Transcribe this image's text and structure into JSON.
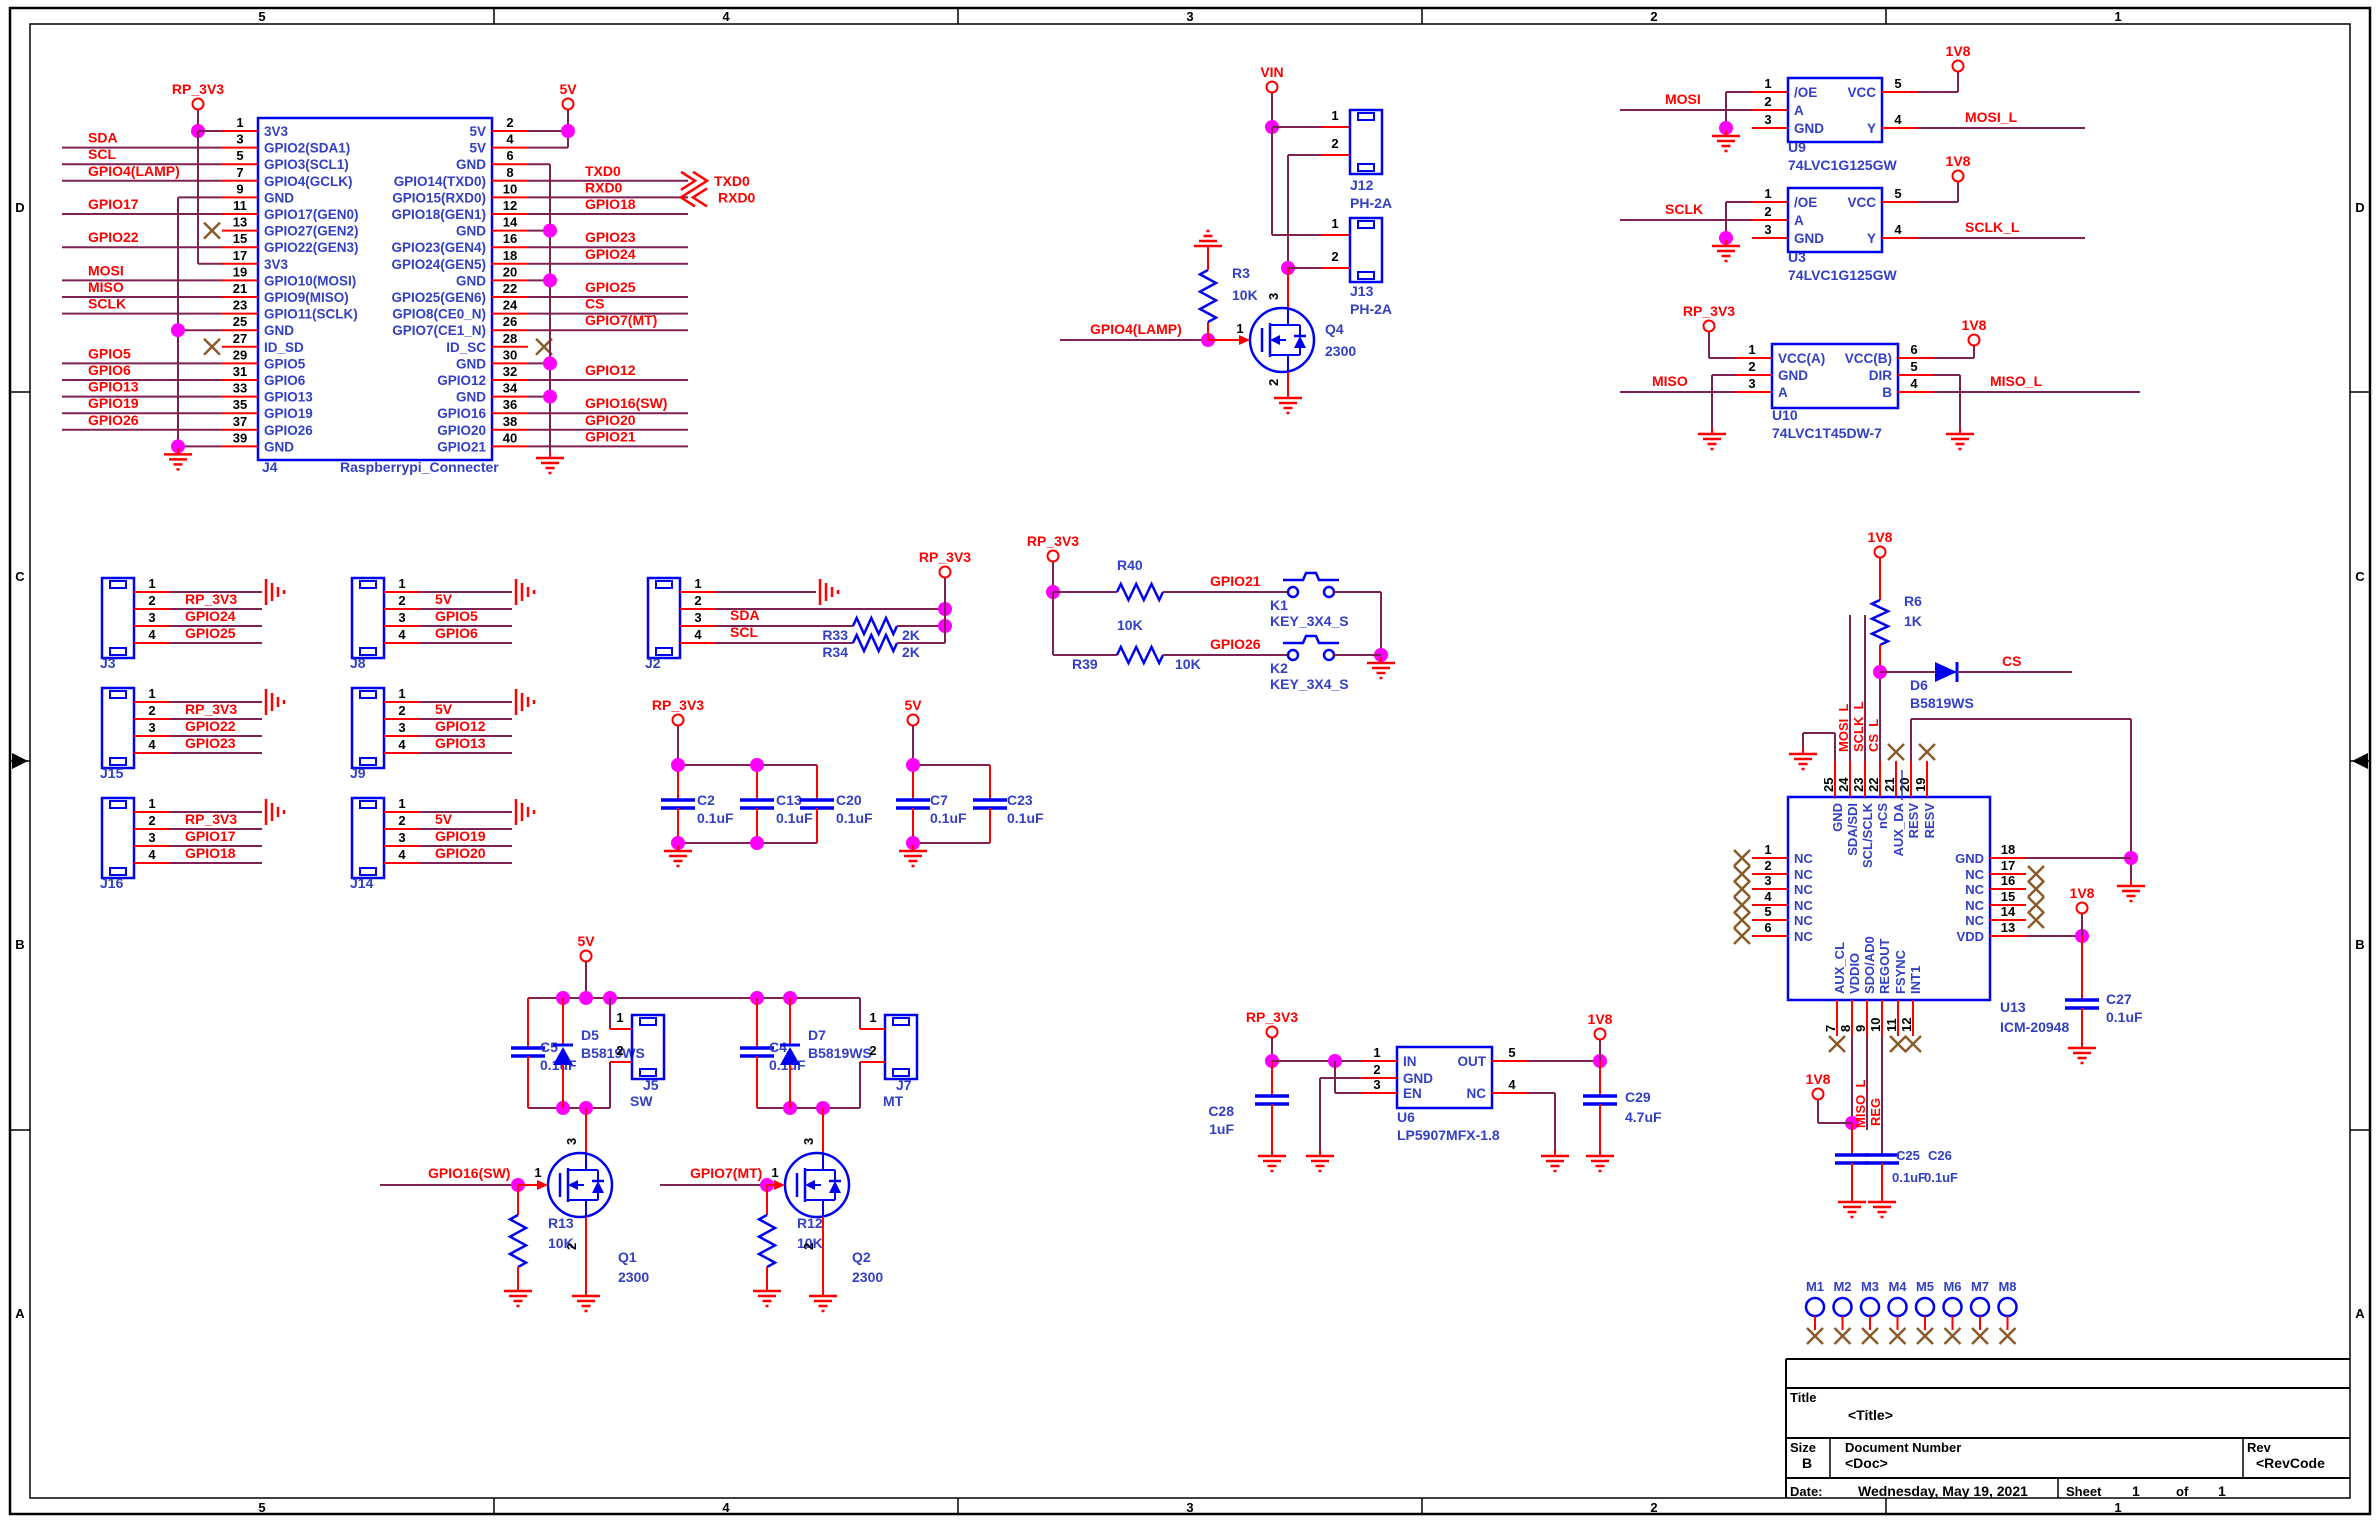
{
  "colors": {
    "wire": "#7d2253",
    "pin": "#ff0000",
    "component": "#0000f0",
    "ic_text": "#3340c5",
    "net_label": "#ff0000",
    "junction": "#ff00ff",
    "no_connect": "#8a5a28",
    "black": "#000000"
  },
  "sheet": {
    "top_ticks": [
      "5",
      "4",
      "3",
      "2",
      "1"
    ],
    "bottom_ticks": [
      "5",
      "4",
      "3",
      "2",
      "1"
    ],
    "left_ticks": [
      "D",
      "C",
      "B",
      "A"
    ],
    "right_ticks": [
      "D",
      "C",
      "B",
      "A"
    ]
  },
  "title_block": {
    "title_label": "Title",
    "title_value": "<Title>",
    "size_label": "Size",
    "size_value": "B",
    "doc_label": "Document Number",
    "doc_value": "<Doc>",
    "rev_label": "Rev",
    "rev_value": "<RevCode",
    "date_label": "Date:",
    "date_value": "Wednesday, May 19, 2021",
    "sheet_label": "Sheet",
    "sheet_number": "1",
    "of_label": "of",
    "sheet_total": "1"
  },
  "power_flags": {
    "rp3v3": "RP_3V3",
    "v5": "5V",
    "vin": "VIN",
    "v1v8": "1V8"
  },
  "offpage": {
    "txd0": "TXD0",
    "rxd0": "RXD0"
  },
  "j4": {
    "ref": "J4",
    "part": "Raspberrypi_Connecter",
    "left_pins": [
      {
        "num": "1",
        "label": "3V3",
        "net": ""
      },
      {
        "num": "3",
        "label": "GPIO2(SDA1)",
        "net": "SDA"
      },
      {
        "num": "5",
        "label": "GPIO3(SCL1)",
        "net": "SCL"
      },
      {
        "num": "7",
        "label": "GPIO4(GCLK)",
        "net": "GPIO4(LAMP)"
      },
      {
        "num": "9",
        "label": "GND",
        "net": ""
      },
      {
        "num": "11",
        "label": "GPIO17(GEN0)",
        "net": "GPIO17"
      },
      {
        "num": "13",
        "label": "GPIO27(GEN2)",
        "net": ""
      },
      {
        "num": "15",
        "label": "GPIO22(GEN3)",
        "net": "GPIO22"
      },
      {
        "num": "17",
        "label": "3V3",
        "net": ""
      },
      {
        "num": "19",
        "label": "GPIO10(MOSI)",
        "net": "MOSI"
      },
      {
        "num": "21",
        "label": "GPIO9(MISO)",
        "net": "MISO"
      },
      {
        "num": "23",
        "label": "GPIO11(SCLK)",
        "net": "SCLK"
      },
      {
        "num": "25",
        "label": "GND",
        "net": ""
      },
      {
        "num": "27",
        "label": "ID_SD",
        "net": ""
      },
      {
        "num": "29",
        "label": "GPIO5",
        "net": "GPIO5"
      },
      {
        "num": "31",
        "label": "GPIO6",
        "net": "GPIO6"
      },
      {
        "num": "33",
        "label": "GPIO13",
        "net": "GPIO13"
      },
      {
        "num": "35",
        "label": "GPIO19",
        "net": "GPIO19"
      },
      {
        "num": "37",
        "label": "GPIO26",
        "net": "GPIO26"
      },
      {
        "num": "39",
        "label": "GND",
        "net": ""
      }
    ],
    "right_pins": [
      {
        "num": "2",
        "label": "5V",
        "net": ""
      },
      {
        "num": "4",
        "label": "5V",
        "net": ""
      },
      {
        "num": "6",
        "label": "GND",
        "net": ""
      },
      {
        "num": "8",
        "label": "GPIO14(TXD0)",
        "net": "TXD0"
      },
      {
        "num": "10",
        "label": "GPIO15(RXD0)",
        "net": "RXD0"
      },
      {
        "num": "12",
        "label": "GPIO18(GEN1)",
        "net": "GPIO18"
      },
      {
        "num": "14",
        "label": "GND",
        "net": ""
      },
      {
        "num": "16",
        "label": "GPIO23(GEN4)",
        "net": "GPIO23"
      },
      {
        "num": "18",
        "label": "GPIO24(GEN5)",
        "net": "GPIO24"
      },
      {
        "num": "20",
        "label": "GND",
        "net": ""
      },
      {
        "num": "22",
        "label": "GPIO25(GEN6)",
        "net": "GPIO25"
      },
      {
        "num": "24",
        "label": "GPIO8(CE0_N)",
        "net": "CS"
      },
      {
        "num": "26",
        "label": "GPIO7(CE1_N)",
        "net": "GPIO7(MT)"
      },
      {
        "num": "28",
        "label": "ID_SC",
        "net": ""
      },
      {
        "num": "30",
        "label": "GND",
        "net": ""
      },
      {
        "num": "32",
        "label": "GPIO12",
        "net": "GPIO12"
      },
      {
        "num": "34",
        "label": "GND",
        "net": ""
      },
      {
        "num": "36",
        "label": "GPIO16",
        "net": "GPIO16(SW)"
      },
      {
        "num": "38",
        "label": "GPIO20",
        "net": "GPIO20"
      },
      {
        "num": "40",
        "label": "GPIO21",
        "net": "GPIO21"
      }
    ]
  },
  "lamp": {
    "net": "GPIO4(LAMP)",
    "j12": {
      "ref": "J12",
      "part": "PH-2A"
    },
    "j13": {
      "ref": "J13",
      "part": "PH-2A"
    },
    "r3": {
      "ref": "R3",
      "value": "10K"
    },
    "q4": {
      "ref": "Q4",
      "value": "2300",
      "pin_d": "3",
      "pin_g": "1",
      "pin_s": "2"
    },
    "pin1": "1",
    "pin2": "2"
  },
  "u9": {
    "ref": "U9",
    "part": "74LVC1G125GW",
    "in": "MOSI",
    "out": "MOSI_L",
    "left_pins": [
      {
        "num": "1",
        "label": "/OE"
      },
      {
        "num": "2",
        "label": "A"
      },
      {
        "num": "3",
        "label": "GND"
      }
    ],
    "right_pins": [
      {
        "num": "5",
        "label": "VCC"
      },
      {
        "num": "4",
        "label": "Y"
      }
    ]
  },
  "u3": {
    "ref": "U3",
    "part": "74LVC1G125GW",
    "in": "SCLK",
    "out": "SCLK_L",
    "left_pins": [
      {
        "num": "1",
        "label": "/OE"
      },
      {
        "num": "2",
        "label": "A"
      },
      {
        "num": "3",
        "label": "GND"
      }
    ],
    "right_pins": [
      {
        "num": "5",
        "label": "VCC"
      },
      {
        "num": "4",
        "label": "Y"
      }
    ]
  },
  "u10": {
    "ref": "U10",
    "part": "74LVC1T45DW-7",
    "in": "MISO",
    "out": "MISO_L",
    "left_pins": [
      {
        "num": "1",
        "label": "VCC(A)"
      },
      {
        "num": "2",
        "label": "GND"
      },
      {
        "num": "3",
        "label": "A"
      }
    ],
    "right_pins": [
      {
        "num": "6",
        "label": "VCC(B)"
      },
      {
        "num": "5",
        "label": "DIR"
      },
      {
        "num": "4",
        "label": "B"
      }
    ]
  },
  "headers": {
    "pin_numbers": [
      "1",
      "2",
      "3",
      "4"
    ],
    "j3": {
      "ref": "J3",
      "nets": [
        "",
        "RP_3V3",
        "GPIO24",
        "GPIO25"
      ]
    },
    "j8": {
      "ref": "J8",
      "nets": [
        "",
        "5V",
        "GPIO5",
        "GPIO6"
      ]
    },
    "j15": {
      "ref": "J15",
      "nets": [
        "",
        "RP_3V3",
        "GPIO22",
        "GPIO23"
      ]
    },
    "j9": {
      "ref": "J9",
      "nets": [
        "",
        "5V",
        "GPIO12",
        "GPIO13"
      ]
    },
    "j16": {
      "ref": "J16",
      "nets": [
        "",
        "RP_3V3",
        "GPIO17",
        "GPIO18"
      ]
    },
    "j14": {
      "ref": "J14",
      "nets": [
        "",
        "5V",
        "GPIO19",
        "GPIO20"
      ]
    }
  },
  "j2": {
    "ref": "J2",
    "sda": "SDA",
    "scl": "SCL",
    "r33": {
      "ref": "R33",
      "value": "2K"
    },
    "r34": {
      "ref": "R34",
      "value": "2K"
    }
  },
  "cap_bank_3v3": {
    "caps": [
      {
        "ref": "C2",
        "value": "0.1uF"
      },
      {
        "ref": "C13",
        "value": "0.1uF"
      },
      {
        "ref": "C20",
        "value": "0.1uF"
      }
    ]
  },
  "cap_bank_5v": {
    "caps": [
      {
        "ref": "C7",
        "value": "0.1uF"
      },
      {
        "ref": "C23",
        "value": "0.1uF"
      }
    ]
  },
  "keys": {
    "r40": {
      "ref": "R40",
      "value": "10K"
    },
    "r39": {
      "ref": "R39",
      "value": "10K"
    },
    "net1": "GPIO21",
    "net2": "GPIO26",
    "k1": {
      "ref": "K1",
      "part": "KEY_3X4_S"
    },
    "k2": {
      "ref": "K2",
      "part": "KEY_3X4_S"
    }
  },
  "sw_circuit": {
    "net": "GPIO16(SW)",
    "c": {
      "ref": "C5",
      "value": "0.1uF"
    },
    "d": {
      "ref": "D5",
      "part": "B5819WS"
    },
    "j": {
      "ref": "J5",
      "name": "SW"
    },
    "q": {
      "ref": "Q1",
      "value": "2300",
      "pin_d": "3",
      "pin_g": "1",
      "pin_s": "2"
    },
    "r": {
      "ref": "R13",
      "value": "10K"
    }
  },
  "mt_circuit": {
    "net": "GPIO7(MT)",
    "c": {
      "ref": "C4",
      "value": "0.1uF"
    },
    "d": {
      "ref": "D7",
      "part": "B5819WS"
    },
    "j": {
      "ref": "J7",
      "name": "MT"
    },
    "q": {
      "ref": "Q2",
      "value": "2300",
      "pin_d": "3",
      "pin_g": "1",
      "pin_s": "2"
    },
    "r": {
      "ref": "R12",
      "value": "10K"
    }
  },
  "u6": {
    "ref": "U6",
    "part": "LP5907MFX-1.8",
    "left_pins": [
      {
        "num": "1",
        "label": "IN"
      },
      {
        "num": "2",
        "label": "GND"
      },
      {
        "num": "3",
        "label": "EN"
      }
    ],
    "right_pins": [
      {
        "num": "5",
        "label": "OUT"
      },
      {
        "num": "4",
        "label": "NC"
      }
    ],
    "cin": {
      "ref": "C28",
      "value": "1uF"
    },
    "cout": {
      "ref": "C29",
      "value": "4.7uF"
    }
  },
  "u13": {
    "ref": "U13",
    "part": "ICM-20948",
    "top_pins": [
      {
        "num": "25",
        "label": "GND"
      },
      {
        "num": "24",
        "label": "SDA/SDI"
      },
      {
        "num": "23",
        "label": "SCL/SCLK"
      },
      {
        "num": "22",
        "label": "nCS"
      },
      {
        "num": "21",
        "label": "AUX_DA"
      },
      {
        "num": "20",
        "label": "RESV"
      },
      {
        "num": "19",
        "label": "RESV"
      }
    ],
    "left_pins": [
      {
        "num": "1",
        "label": "NC"
      },
      {
        "num": "2",
        "label": "NC"
      },
      {
        "num": "3",
        "label": "NC"
      },
      {
        "num": "4",
        "label": "NC"
      },
      {
        "num": "5",
        "label": "NC"
      },
      {
        "num": "6",
        "label": "NC"
      }
    ],
    "right_pins": [
      {
        "num": "18",
        "label": "GND"
      },
      {
        "num": "17",
        "label": "NC"
      },
      {
        "num": "16",
        "label": "NC"
      },
      {
        "num": "15",
        "label": "NC"
      },
      {
        "num": "14",
        "label": "NC"
      },
      {
        "num": "13",
        "label": "VDD"
      }
    ],
    "bottom_pins": [
      {
        "num": "7",
        "label": "AUX_CL"
      },
      {
        "num": "8",
        "label": "VDDIO"
      },
      {
        "num": "9",
        "label": "SDO/AD0"
      },
      {
        "num": "10",
        "label": "REGOUT"
      },
      {
        "num": "11",
        "label": "FSYNC"
      },
      {
        "num": "12",
        "label": "INT1"
      }
    ],
    "mosi_l": "MOSI_L",
    "sclk_l": "SCLK_L",
    "cs_l": "CS_L",
    "miso_l": "MISO_L",
    "reg": "REG",
    "cs": "CS",
    "r6": {
      "ref": "R6",
      "value": "1K"
    },
    "d6": {
      "ref": "D6",
      "part": "B5819WS"
    },
    "c25": {
      "ref": "C25",
      "value": "0.1uF"
    },
    "c26": {
      "ref": "C26",
      "value": "0.1uF"
    },
    "c27": {
      "ref": "C27",
      "value": "0.1uF"
    }
  },
  "mounts": [
    "M1",
    "M2",
    "M3",
    "M4",
    "M5",
    "M6",
    "M7",
    "M8"
  ]
}
